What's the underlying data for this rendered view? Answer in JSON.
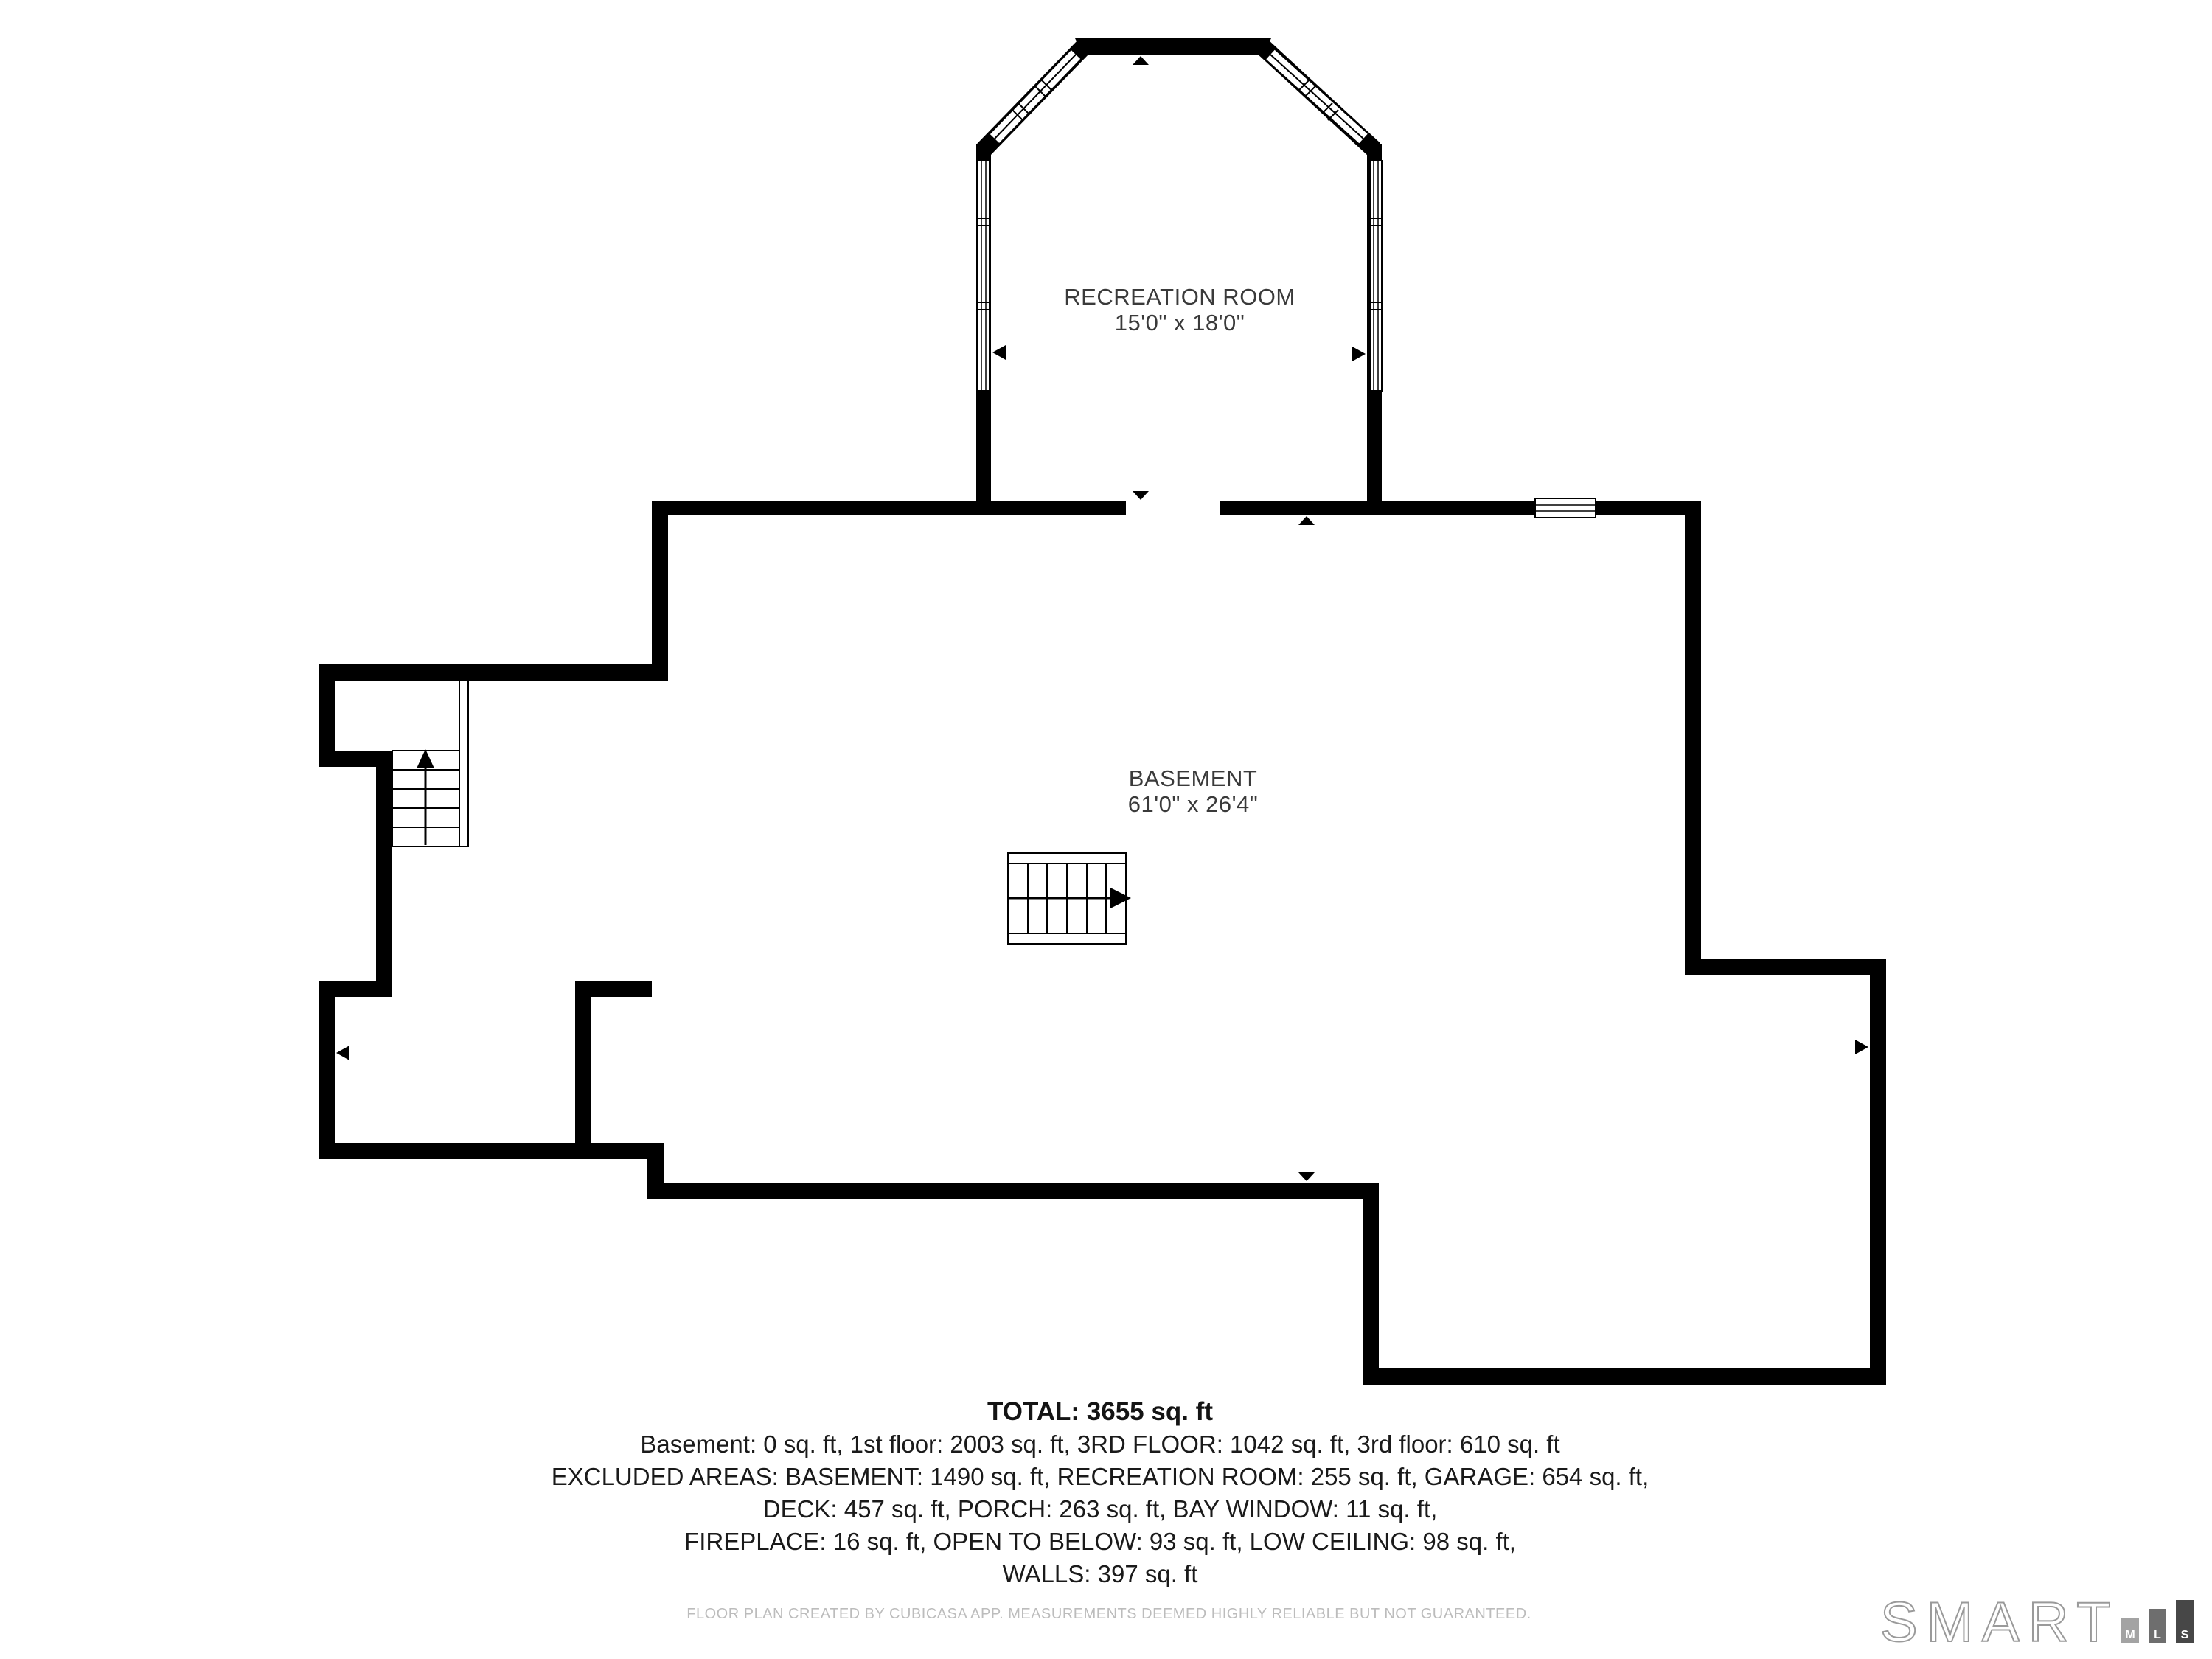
{
  "plan": {
    "rooms": [
      {
        "name": "RECREATION ROOM",
        "dimensions": "15'0\" x 18'0\""
      },
      {
        "name": "BASEMENT",
        "dimensions": "61'0\" x 26'4\""
      }
    ],
    "summary": {
      "total": "TOTAL: 3655 sq. ft",
      "lines": [
        "Basement: 0 sq. ft, 1st floor: 2003 sq. ft, 3RD FLOOR: 1042 sq. ft, 3rd floor: 610 sq. ft",
        "EXCLUDED AREAS: BASEMENT: 1490 sq. ft, RECREATION ROOM: 255 sq. ft, GARAGE: 654 sq. ft,",
        "DECK: 457 sq. ft, PORCH: 263 sq. ft, BAY WINDOW: 11 sq. ft,",
        "FIREPLACE: 16 sq. ft, OPEN TO BELOW: 93 sq. ft, LOW CEILING: 98 sq. ft,",
        "WALLS: 397 sq. ft"
      ]
    },
    "disclaimer": "FLOOR PLAN CREATED BY CUBICASA APP. MEASUREMENTS DEEMED HIGHLY RELIABLE BUT NOT GUARANTEED.",
    "colors": {
      "wall": "#000000",
      "background": "#ffffff",
      "room_label": "#3a3a3a",
      "summary_text": "#1a1a1a",
      "disclaimer_text": "#bcbcbc"
    },
    "icons": {
      "door_arrows": [
        "up-arrow-icon",
        "down-arrow-icon",
        "left-arrow-icon",
        "right-arrow-icon"
      ],
      "stair_direction": "up-arrow-icon"
    }
  },
  "logo": {
    "brand": "SMART",
    "outline_color": "#9a9a9a",
    "bars": [
      {
        "letter": "M",
        "color": "#a3a3a3"
      },
      {
        "letter": "L",
        "color": "#6e6e6e"
      },
      {
        "letter": "S",
        "color": "#474747"
      }
    ]
  }
}
